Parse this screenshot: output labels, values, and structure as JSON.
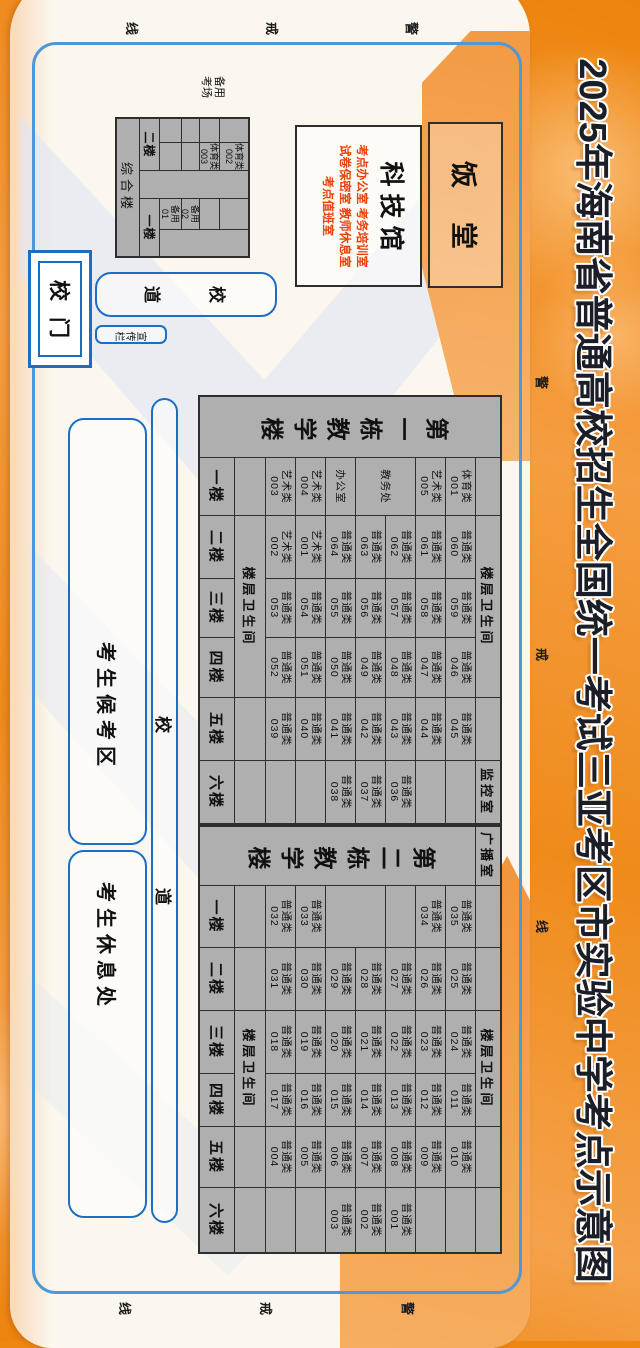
{
  "title": "2025年海南省普通高校招生全国统一考试三亚考区市实验中学考点示意图",
  "warning_line_chars": [
    "警",
    "戒",
    "线"
  ],
  "campus": {
    "gate_label": "校门",
    "gate_road_chars": [
      "校",
      "道"
    ],
    "bulletin_label": "宣传栏",
    "main_road_chars": [
      "校",
      "道"
    ],
    "waiting_area_label": "考生候考区",
    "rest_area_label": "考生休息处",
    "canteen_label": "饭堂",
    "science_hall": {
      "name": "科技馆",
      "room_lines": [
        "考点办公室 考务培训室",
        "试卷保密室 教师休息室",
        "考点值班室"
      ]
    },
    "backup_exam_label": [
      "备用",
      "考场"
    ]
  },
  "composite_building": {
    "name": "综合楼",
    "cells": [
      {
        "r": 0,
        "c": 0,
        "t": ""
      },
      {
        "r": 0,
        "c": 1,
        "t": "体育类|002"
      },
      {
        "r": 0,
        "c": 2,
        "rs": 5,
        "t": ""
      },
      {
        "r": 0,
        "c": 3,
        "t": ""
      },
      {
        "r": 0,
        "c": 4,
        "rs": 4,
        "t": ""
      },
      {
        "r": 1,
        "c": 0,
        "t": ""
      },
      {
        "r": 1,
        "c": 1,
        "t": "体育类|003"
      },
      {
        "r": 1,
        "c": 3,
        "t": ""
      },
      {
        "r": 2,
        "c": 0,
        "t": ""
      },
      {
        "r": 2,
        "c": 1,
        "t": ""
      },
      {
        "r": 2,
        "c": 3,
        "t": "备用|02"
      },
      {
        "r": 3,
        "c": 0,
        "t": ""
      },
      {
        "r": 3,
        "c": 1,
        "t": ""
      },
      {
        "r": 3,
        "c": 3,
        "t": "备用|01"
      },
      {
        "r": 4,
        "c": 0,
        "cs": 2,
        "t": "二楼",
        "k": "floor"
      },
      {
        "r": 4,
        "c": 3,
        "cs": 2,
        "t": "一楼",
        "k": "floor"
      },
      {
        "r": 5,
        "c": 0,
        "cs": 5,
        "t": "综合楼",
        "k": "bname"
      }
    ]
  },
  "buildings": [
    {
      "name": "第一栋教学楼",
      "broadcast_over_header": null,
      "top_row": [
        {
          "c": 1,
          "t": ""
        },
        {
          "c": 2,
          "cs": 3,
          "t": "楼层卫生间"
        },
        {
          "c": 5,
          "t": ""
        },
        {
          "c": 6,
          "t": "监控室"
        }
      ],
      "bottom_row": [
        {
          "c": 1,
          "t": ""
        },
        {
          "c": 2,
          "cs": 3,
          "t": "楼层卫生间"
        },
        {
          "c": 5,
          "t": ""
        },
        {
          "c": 6,
          "t": ""
        }
      ],
      "floors": [
        {
          "label": "一楼",
          "rooms": [
            "体育类|001",
            "艺术类|005",
            {
              "t": "教务处",
              "rs": 2
            },
            null,
            "办公室",
            "艺术类|004",
            "艺术类|003"
          ]
        },
        {
          "label": "二楼",
          "rooms": [
            "普通类|060",
            "普通类|061",
            "普通类|062",
            "普通类|063",
            "普通类|064",
            "艺术类|001",
            "艺术类|002"
          ]
        },
        {
          "label": "三楼",
          "rooms": [
            "普通类|059",
            "普通类|058",
            "普通类|057",
            "普通类|056",
            "普通类|055",
            "普通类|054",
            "普通类|053"
          ]
        },
        {
          "label": "四楼",
          "rooms": [
            "普通类|046",
            "普通类|047",
            "普通类|048",
            "普通类|049",
            "普通类|050",
            "普通类|051",
            "普通类|052"
          ]
        },
        {
          "label": "五楼",
          "rooms": [
            "普通类|045",
            "普通类|044",
            "普通类|043",
            "普通类|042",
            "普通类|041",
            "普通类|040",
            "普通类|039"
          ]
        },
        {
          "label": "六楼",
          "rooms": [
            "",
            "",
            "普通类|036",
            "普通类|037",
            "普通类|038",
            "",
            ""
          ]
        }
      ]
    },
    {
      "name": "第二栋教学楼",
      "broadcast_over_header": "广播室",
      "top_row": [
        {
          "c": 1,
          "t": ""
        },
        {
          "c": 2,
          "t": ""
        },
        {
          "c": 3,
          "cs": 2,
          "t": "楼层卫生间"
        },
        {
          "c": 5,
          "t": ""
        },
        {
          "c": 6,
          "t": ""
        }
      ],
      "bottom_row": [
        {
          "c": 1,
          "t": ""
        },
        {
          "c": 2,
          "t": ""
        },
        {
          "c": 3,
          "cs": 2,
          "t": "楼层卫生间"
        },
        {
          "c": 5,
          "t": ""
        },
        {
          "c": 6,
          "t": ""
        }
      ],
      "floors": [
        {
          "label": "一楼",
          "rooms": [
            "普通类|035",
            "普通类|034",
            "",
            {
              "t": "",
              "rs": 2
            },
            null,
            "普通类|033",
            "普通类|032"
          ]
        },
        {
          "label": "二楼",
          "rooms": [
            "普通类|025",
            "普通类|026",
            "普通类|027",
            "普通类|028",
            "普通类|029",
            "普通类|030",
            "普通类|031"
          ]
        },
        {
          "label": "三楼",
          "rooms": [
            "普通类|024",
            "普通类|023",
            "普通类|022",
            "普通类|021",
            "普通类|020",
            "普通类|019",
            "普通类|018"
          ]
        },
        {
          "label": "四楼",
          "rooms": [
            "普通类|011",
            "普通类|012",
            "普通类|013",
            "普通类|014",
            "普通类|015",
            "普通类|016",
            "普通类|017"
          ]
        },
        {
          "label": "五楼",
          "rooms": [
            "普通类|010",
            "普通类|009",
            "普通类|008",
            "普通类|007",
            "普通类|006",
            "普通类|005",
            "普通类|004"
          ]
        },
        {
          "label": "六楼",
          "rooms": [
            "",
            "",
            "普通类|001",
            "普通类|002",
            "普通类|003",
            "",
            ""
          ]
        }
      ]
    }
  ]
}
